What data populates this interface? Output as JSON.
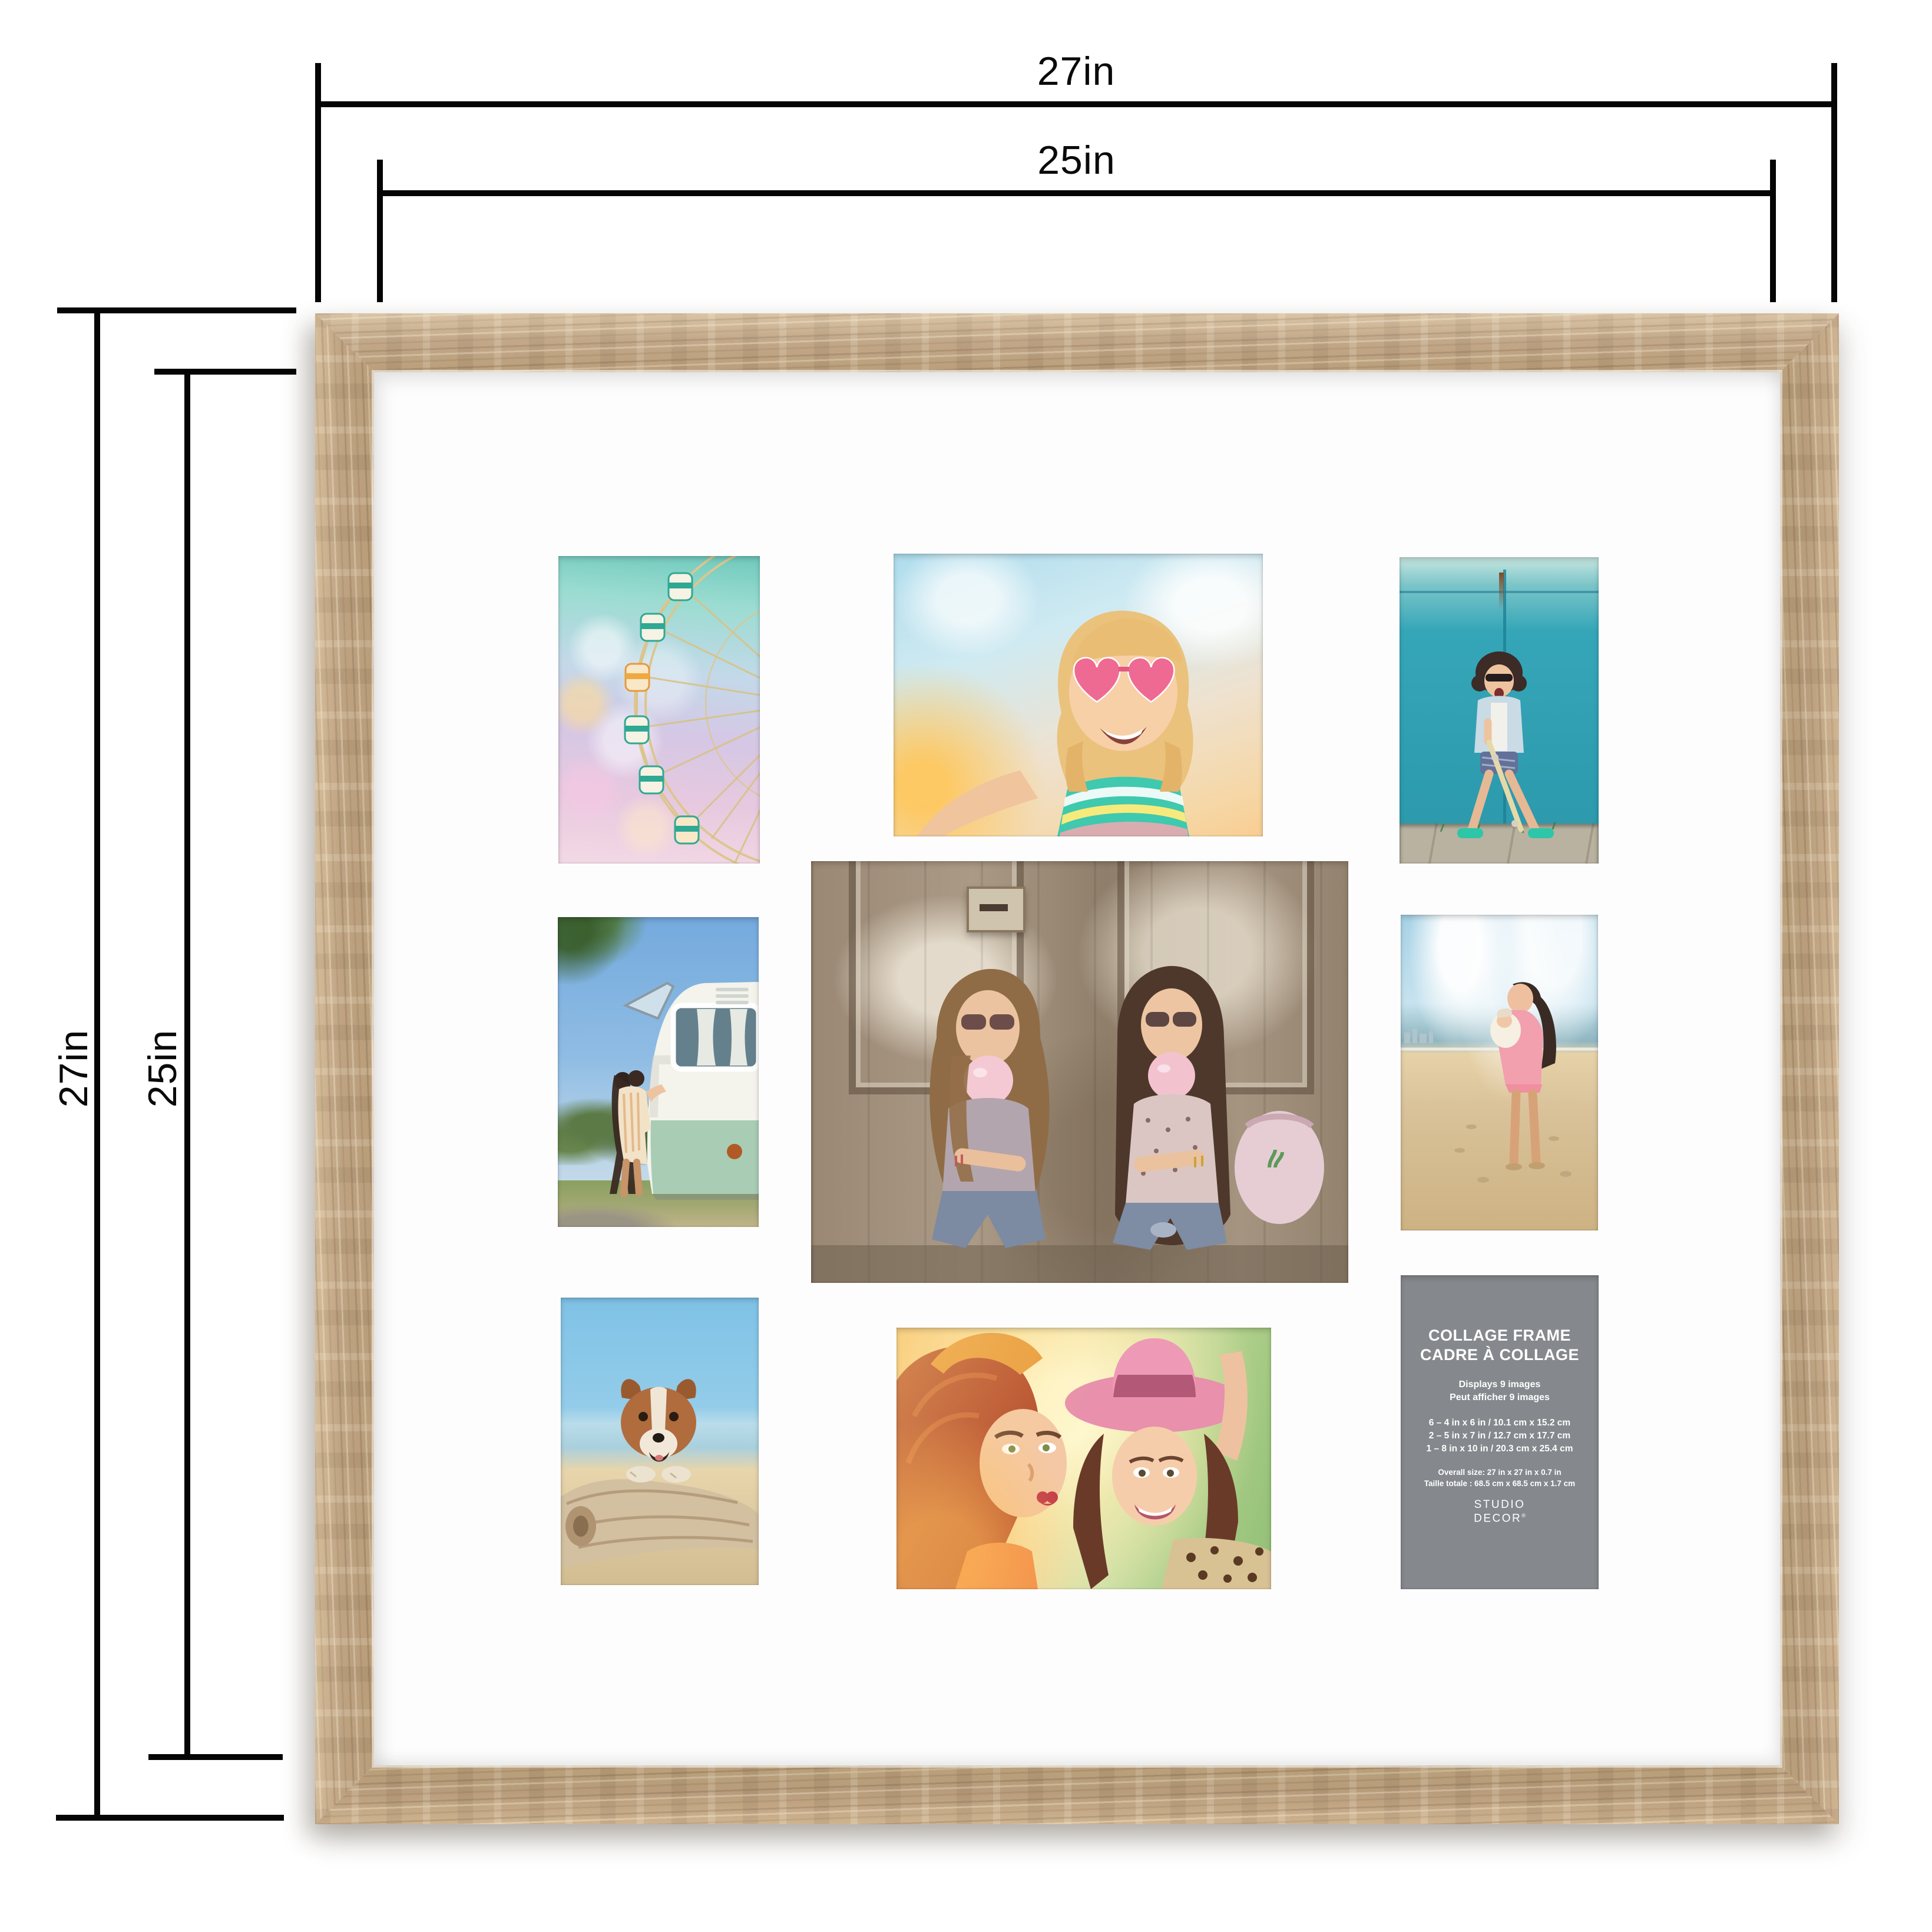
{
  "dimension_annotations": {
    "top_outer": "27in",
    "top_inner": "25in",
    "left_outer": "27in",
    "left_inner": "25in"
  },
  "colors": {
    "frame_wood": "#c0a17c",
    "mat": "#fdfdfe",
    "annotation_line": "#050505",
    "card_bg": "#85888c",
    "card_text": "#ffffff"
  },
  "photos": [
    {
      "id": "ferris-wheel",
      "description": "pastel ferris wheel with bokeh lights, 4x6 portrait"
    },
    {
      "id": "girl-selfie",
      "description": "girl with heart sunglasses taking sunny selfie, 5x7 landscape"
    },
    {
      "id": "skater-teal-wall",
      "description": "woman with skateboard shouting in front of teal wall, 4x6 portrait"
    },
    {
      "id": "camper-couple",
      "description": "couple kissing beside vintage green camper van, 4x6 portrait"
    },
    {
      "id": "bubblegum-friends",
      "description": "two friends blowing pink bubble gum in front of weathered door, 8x10 landscape"
    },
    {
      "id": "beach-mother-child",
      "description": "mother holding child on sandy beach, 4x6 portrait"
    },
    {
      "id": "dog-driftwood",
      "description": "dog resting on driftwood log at beach, 4x6 portrait"
    },
    {
      "id": "pink-hat-selfie",
      "description": "two smiling friends, one in pink fedora, warm sunlight, 5x7 landscape"
    }
  ],
  "info_card": {
    "title_line1": "COLLAGE FRAME",
    "title_line2": "CADRE À COLLAGE",
    "subtitle_line1": "Displays 9 images",
    "subtitle_line2": "Peut afficher 9 images",
    "sizes": [
      "6 – 4 in x 6 in / 10.1 cm x 15.2 cm",
      "2 – 5 in x 7 in / 12.7 cm x 17.7 cm",
      "1 – 8 in x 10 in / 20.3 cm x 25.4 cm"
    ],
    "overall_line1": "Overall size: 27 in x 27 in x 0.7 in",
    "overall_line2": "Taille totale : 68.5 cm x 68.5 cm x 1.7 cm",
    "brand_line1": "STUDIO",
    "brand_line2": "DECOR",
    "brand_reg": "®"
  }
}
